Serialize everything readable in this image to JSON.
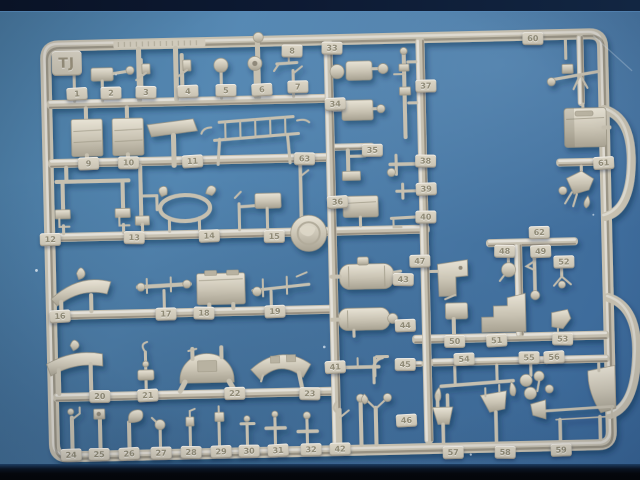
{
  "sprue": {
    "letter": "TJ",
    "tags": [
      "1",
      "2",
      "3",
      "4",
      "5",
      "6",
      "7",
      "8",
      "9",
      "10",
      "11",
      "12",
      "13",
      "14",
      "15",
      "16",
      "17",
      "18",
      "19",
      "20",
      "21",
      "22",
      "23",
      "24",
      "25",
      "26",
      "27",
      "28",
      "29",
      "30",
      "31",
      "32",
      "33",
      "34",
      "35",
      "36",
      "37",
      "38",
      "39",
      "40",
      "41",
      "42",
      "43",
      "44",
      "45",
      "46",
      "47",
      "48",
      "49",
      "50",
      "51",
      "52",
      "53",
      "54",
      "55",
      "56",
      "57",
      "58",
      "59",
      "60",
      "61",
      "62",
      "63"
    ]
  },
  "colors": {
    "plastic": "#c6c0b0",
    "plastic_highlight": "#e8e3d5",
    "plastic_shadow": "#9b9584",
    "background_blue": "#4a7aa6",
    "band_top": "#0d1a33",
    "band_bottom": "#05070c",
    "tag_text": "#8f8a76"
  }
}
